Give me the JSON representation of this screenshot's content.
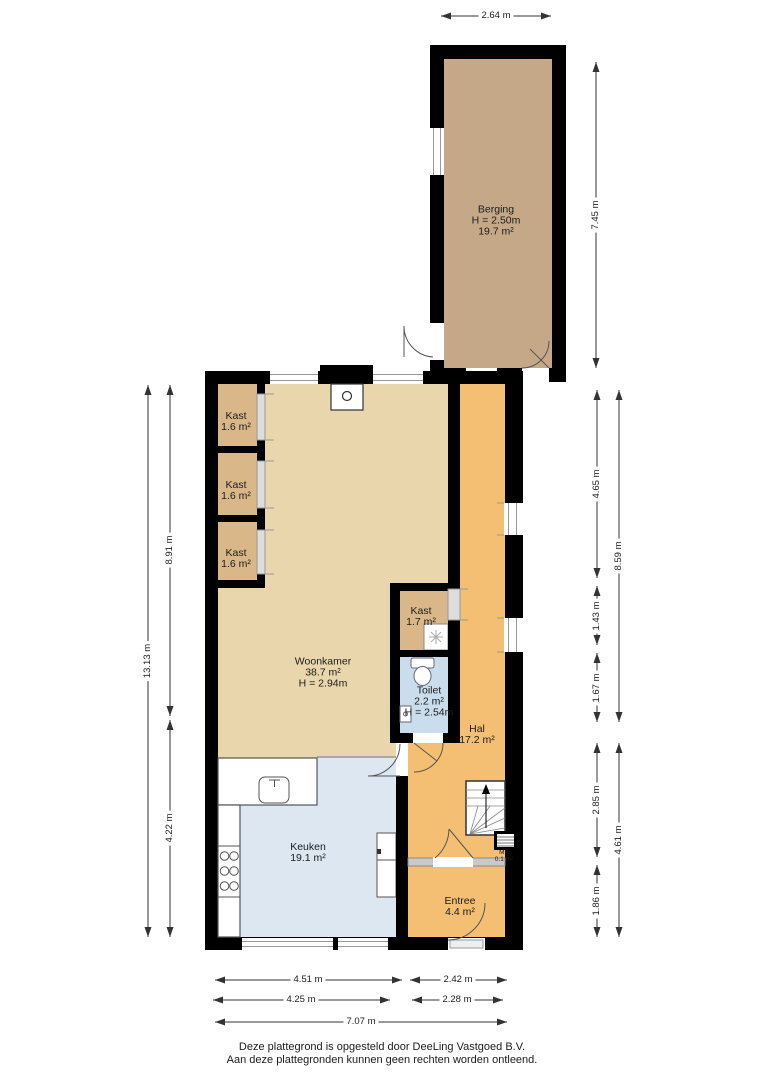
{
  "rooms": {
    "berging": {
      "name": "Berging",
      "height": "H = 2.50m",
      "area": "19.7 m²"
    },
    "kast_1": {
      "name": "Kast",
      "area": "1.6 m²"
    },
    "kast_2": {
      "name": "Kast",
      "area": "1.6 m²"
    },
    "kast_3": {
      "name": "Kast",
      "area": "1.6 m²"
    },
    "woonkamer": {
      "name": "Woonkamer",
      "area": "38.7 m²",
      "height": "H = 2.94m"
    },
    "kast_4": {
      "name": "Kast",
      "area": "1.7 m²"
    },
    "toilet": {
      "name": "Toilet",
      "area": "2.2 m²",
      "height": "H = 2.54m"
    },
    "hal": {
      "name": "Hal",
      "area": "17.2 m²"
    },
    "keuken": {
      "name": "Keuken",
      "area": "19.1 m²"
    },
    "entree": {
      "name": "Entree",
      "area": "4.4 m²"
    },
    "mk": {
      "name": "MK",
      "area": "0.1 m²"
    }
  },
  "dimensions": {
    "top_width": "2.64 m",
    "berging_height": "7.45 m",
    "right_seg_1": "4.65 m",
    "right_seg_2": "1.43 m",
    "right_seg_3": "1.67 m",
    "right_seg_4": "2.85 m",
    "right_seg_5": "1.86 m",
    "right_total_1": "8.59 m",
    "right_total_2": "4.61 m",
    "left_total": "13.13 m",
    "left_seg_1": "8.91 m",
    "left_seg_2": "4.22 m",
    "bottom_left_1": "4.51 m",
    "bottom_right_1": "2.42 m",
    "bottom_left_2": "4.25 m",
    "bottom_right_2": "2.28 m",
    "bottom_total": "7.07 m"
  },
  "footer": {
    "line1": "Deze plattegrond is opgesteld door DeeLing Vastgoed B.V.",
    "line2": "Aan deze plattegronden kunnen geen rechten worden ontleend."
  },
  "colors": {
    "wall": "#000000",
    "berging_floor": "#c5a888",
    "kast_floor": "#d9b788",
    "woonkamer_floor": "#ead6ac",
    "hal_floor": "#f4bf72",
    "keuken_floor": "#dce7f2",
    "toilet_floor": "#cadded",
    "dimension_line": "#333333"
  }
}
